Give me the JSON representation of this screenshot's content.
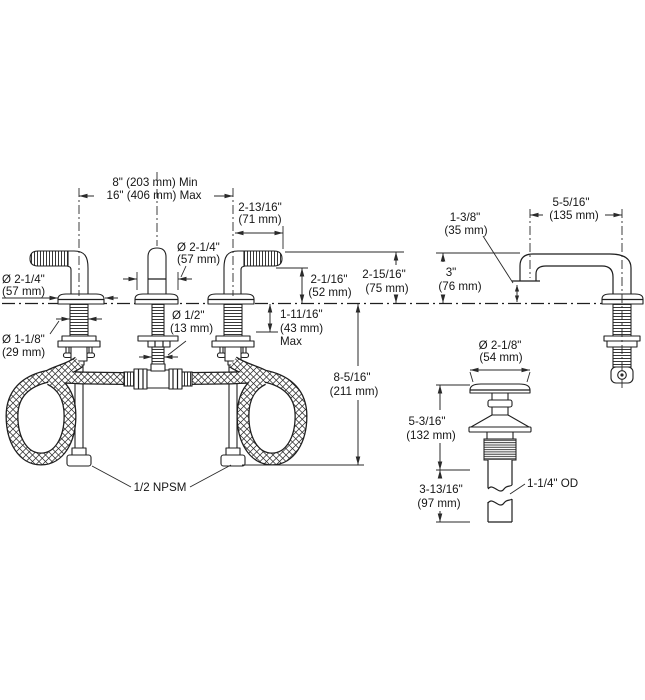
{
  "page": {
    "background": "#ffffff",
    "line_color": "#1f1f1f",
    "text_color": "#161616",
    "description": "Technical specification line drawing of a widespread two-handle bathroom sink faucet: front view with supply hoses, spout side view, and drain assembly view, with dimension annotations."
  },
  "labels": {
    "spread_min": "8\" (203 mm) Min",
    "spread_max": "16\" (406 mm) Max",
    "handle_reach_in": "2-13/16\"",
    "handle_reach_mm": "(71 mm)",
    "spout_base_dia_in": "Ø 2-1/4\"",
    "spout_base_dia_mm": "(57 mm)",
    "handle_base_dia_in": "Ø 2-1/4\"",
    "handle_base_dia_mm": "(57 mm)",
    "handle_shank_dia_in": "Ø 1-1/8\"",
    "handle_shank_dia_mm": "(29 mm)",
    "spout_shank_dia_in": "Ø 1/2\"",
    "spout_shank_dia_mm": "(13 mm)",
    "handle_height_low_in": "2-1/16\"",
    "handle_height_low_mm": "(52 mm)",
    "handle_height_high_in": "2-15/16\"",
    "handle_height_high_mm": "(75 mm)",
    "deck_thickness_in": "1-11/16\"",
    "deck_thickness_mm": "(43 mm)",
    "deck_thickness_max": "Max",
    "hose_length_in": "8-5/16\"",
    "hose_length_mm": "(211 mm)",
    "supply_connection": "1/2 NPSM",
    "spout_reach_in": "5-5/16\"",
    "spout_reach_mm": "(135 mm)",
    "outlet_offset_in": "1-3/8\"",
    "outlet_offset_mm": "(35 mm)",
    "spout_height_in": "3\"",
    "spout_height_mm": "(76 mm)",
    "drain_flange_dia_in": "Ø 2-1/8\"",
    "drain_flange_dia_mm": "(54 mm)",
    "drain_upper_len_in": "5-3/16\"",
    "drain_upper_len_mm": "(132 mm)",
    "drain_lower_len_in": "3-13/16\"",
    "drain_lower_len_mm": "(97 mm)",
    "drain_od": "1-1/4\" OD"
  }
}
